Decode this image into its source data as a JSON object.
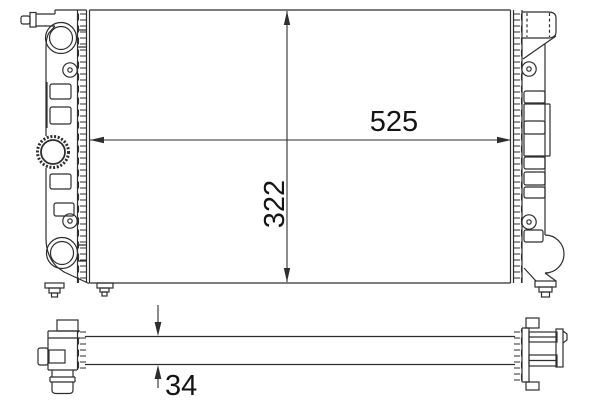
{
  "drawing": {
    "type": "technical_line_drawing",
    "subject": "automotive radiator dimensional diagram",
    "views": [
      {
        "id": "front",
        "description": "front elevation with left tank (hose ports, filler cap, drain) and right tank (top port, mounting bosses, drain plug)"
      },
      {
        "id": "bottom",
        "description": "bottom section view showing core thickness with end fittings"
      }
    ]
  },
  "dims": {
    "width": "525",
    "height": "322",
    "depth": "34"
  },
  "dimensions_meta": [
    {
      "id": "width",
      "value": 525,
      "orientation": "horizontal",
      "applies_to": "core width"
    },
    {
      "id": "height",
      "value": 322,
      "orientation": "vertical",
      "applies_to": "core height"
    },
    {
      "id": "depth",
      "value": 34,
      "orientation": "vertical",
      "applies_to": "core thickness"
    }
  ],
  "colors": {
    "background": "#ffffff",
    "line": "#2e2e2e",
    "text": "#141414"
  }
}
